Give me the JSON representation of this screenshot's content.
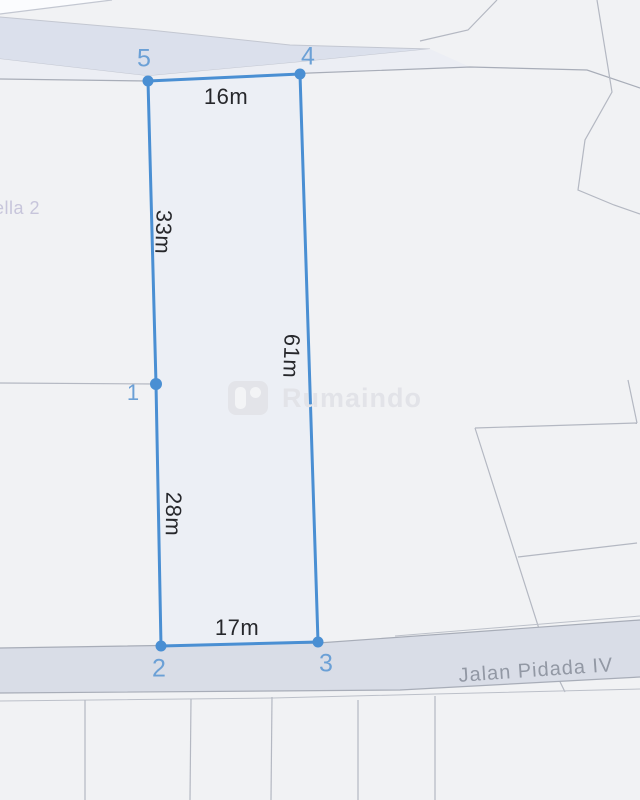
{
  "map": {
    "place_label": "ella 2",
    "street_label": "Jalan Pidada IV",
    "watermark_text": "Rumaindo",
    "colors": {
      "background": "#f1f2f4",
      "road_fill_top": "#dbe0ec",
      "road_fill_bottom": "#d9dde7",
      "sidewalk_fill": "#eceef4",
      "parcel_line": "#b4b8c2",
      "road_edge_line": "#a8adb8",
      "plot_stroke": "#4a8fd3",
      "plot_fill": "#e8edf6",
      "vertex_label_color": "#6ba0d6",
      "measure_text_color": "#26272b",
      "street_text_color": "#9298a4",
      "place_text_color": "#c7c5db",
      "watermark_color": "#e2e3e8"
    }
  },
  "plot": {
    "vertex_labels": [
      "1",
      "2",
      "3",
      "4",
      "5"
    ],
    "measurements": {
      "top": "16m",
      "left_upper": "33m",
      "right": "61m",
      "left_lower": "28m",
      "bottom": "17m"
    }
  }
}
